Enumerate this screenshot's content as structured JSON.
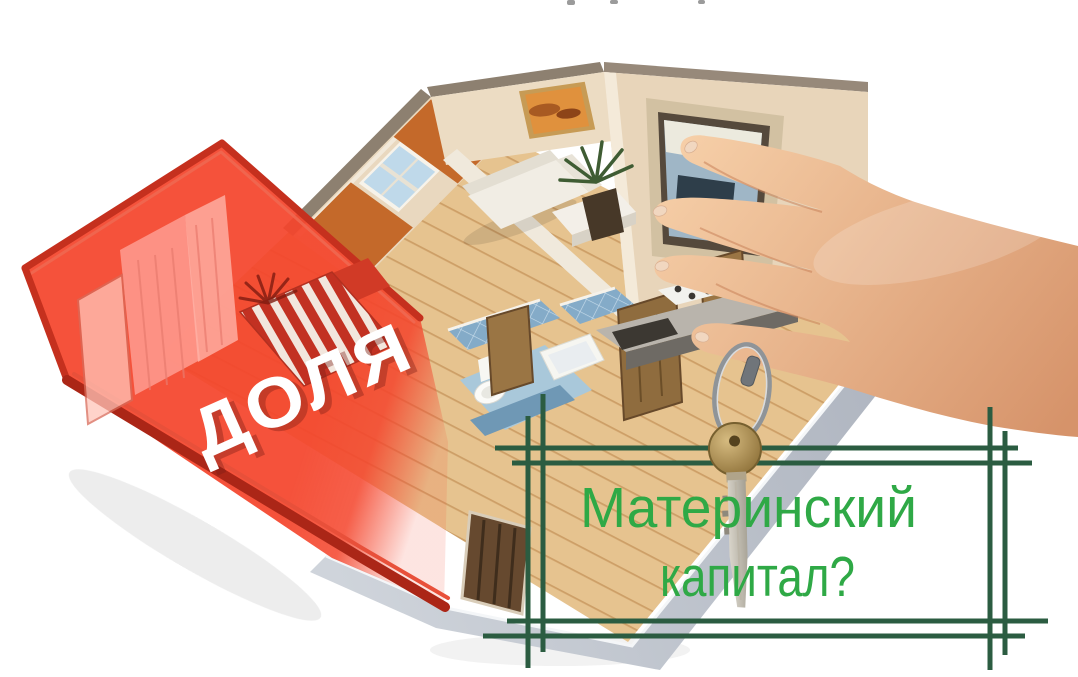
{
  "canvas": {
    "width": 1078,
    "height": 677,
    "background": "#ffffff"
  },
  "overlay": {
    "share_label": "ДОЛЯ",
    "question_line1": "Материнский",
    "question_line2": "капитал?"
  },
  "colors": {
    "question_text": "#2fa946",
    "frame_lines": "#2b5c41",
    "share_overlay_red": "#f4452c",
    "share_label_text": "#ffffff"
  },
  "scene": {
    "objects": [
      "apartment-cutaway-floor-plan",
      "red-share-bedroom",
      "living-room-with-sofa-and-painting",
      "bathroom-blue-tiles",
      "kitchen-with-stove",
      "front-door",
      "hand-holding-key-ring",
      "brass-key",
      "architect-hash-frame"
    ]
  }
}
